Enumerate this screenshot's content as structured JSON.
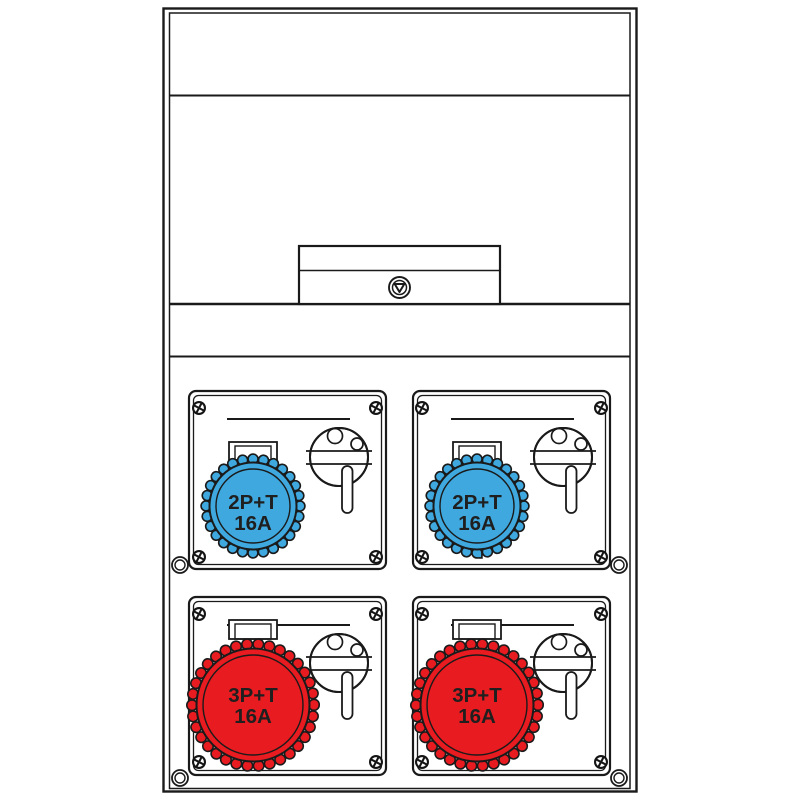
{
  "diagram": {
    "colors": {
      "outline": "#1a1a1a",
      "blue_socket": "#3fa9df",
      "red_socket": "#e81b20",
      "label_text": "#1f1f1f",
      "background": "#ffffff"
    },
    "sockets": [
      {
        "position": "top-left",
        "label_line1": "2P+T",
        "label_line2": "16A",
        "color": "#3fa9df"
      },
      {
        "position": "top-right",
        "label_line1": "2P+T",
        "label_line2": "16A",
        "color": "#3fa9df"
      },
      {
        "position": "bottom-left",
        "label_line1": "3P+T",
        "label_line2": "16A",
        "color": "#e81b20"
      },
      {
        "position": "bottom-right",
        "label_line1": "3P+T",
        "label_line2": "16A",
        "color": "#e81b20"
      }
    ]
  }
}
